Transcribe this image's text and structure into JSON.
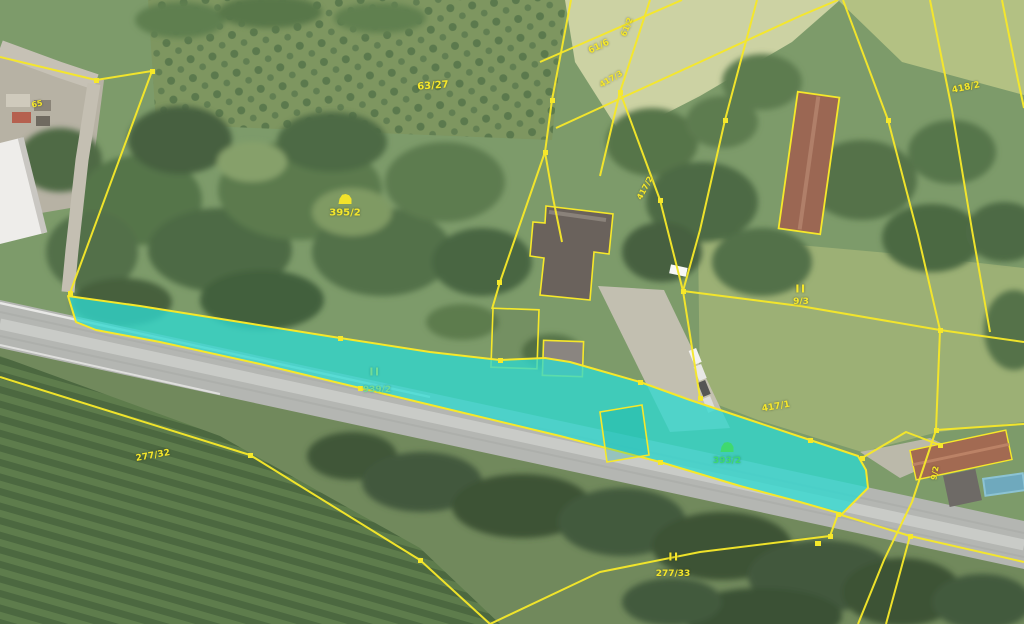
{
  "map": {
    "type": "cadastral-parcel-map-over-aerial-imagery",
    "colors": {
      "parcel_line": "#f6e82a",
      "highlight_fill": "#2fd9cf",
      "label_yellow": "#f5e72b",
      "label_green_on_highlight": "#3fd96f"
    },
    "selected_parcel": {
      "number": "939/2",
      "land_class_symbol": "II"
    },
    "labels": [
      {
        "text": "65",
        "x": 37,
        "y": 104,
        "rot": -12,
        "cls": "y",
        "size": 8
      },
      {
        "text": "63/27",
        "x": 433,
        "y": 86,
        "rot": -4,
        "cls": "y",
        "size": 10
      },
      {
        "text": "61/6",
        "x": 599,
        "y": 47,
        "rot": -26,
        "cls": "y",
        "size": 9
      },
      {
        "text": "61/2",
        "x": 627,
        "y": 27,
        "rot": -68,
        "cls": "y",
        "size": 8
      },
      {
        "text": "417/3",
        "x": 611,
        "y": 79,
        "rot": -30,
        "cls": "y",
        "size": 8
      },
      {
        "text": "417/2",
        "x": 645,
        "y": 188,
        "rot": -62,
        "cls": "y",
        "size": 8
      },
      {
        "text": "418/2",
        "x": 966,
        "y": 88,
        "rot": -12,
        "cls": "y",
        "size": 9
      },
      {
        "text": "395/2",
        "x": 345,
        "y": 213,
        "rot": 0,
        "cls": "y",
        "size": 10,
        "icon": "building-symbol-yellow"
      },
      {
        "text": "II",
        "x": 801,
        "y": 289,
        "rot": 0,
        "cls": "y sym",
        "size": 11
      },
      {
        "text": "9/3",
        "x": 801,
        "y": 302,
        "rot": 0,
        "cls": "y",
        "size": 9
      },
      {
        "text": "II",
        "x": 375,
        "y": 372,
        "rot": 0,
        "cls": "g2 sym",
        "size": 11
      },
      {
        "text": "939/2",
        "x": 377,
        "y": 390,
        "rot": 0,
        "cls": "g2",
        "size": 9
      },
      {
        "text": "393/2",
        "x": 727,
        "y": 461,
        "rot": 0,
        "cls": "g",
        "size": 9,
        "icon": "building-symbol-green"
      },
      {
        "text": "277/32",
        "x": 153,
        "y": 456,
        "rot": -10,
        "cls": "y",
        "size": 9
      },
      {
        "text": "II",
        "x": 674,
        "y": 557,
        "rot": 0,
        "cls": "y sym",
        "size": 11
      },
      {
        "text": "277/33",
        "x": 673,
        "y": 574,
        "rot": 0,
        "cls": "y",
        "size": 9
      },
      {
        "text": "417/1",
        "x": 776,
        "y": 407,
        "rot": -10,
        "cls": "y",
        "size": 9
      },
      {
        "text": "9/2",
        "x": 935,
        "y": 473,
        "rot": -80,
        "cls": "y",
        "size": 8
      }
    ]
  }
}
